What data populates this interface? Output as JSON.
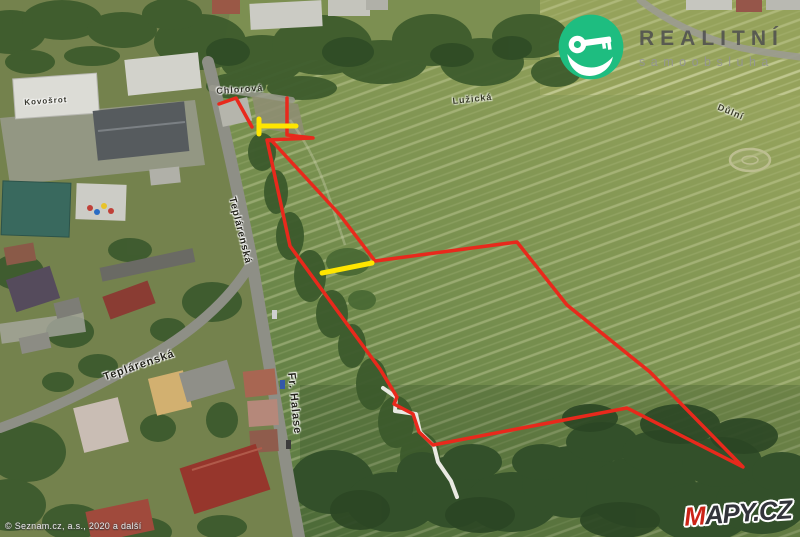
{
  "branding": {
    "realitni": {
      "line1": "REALITNÍ",
      "line2": "samoobsluha",
      "circle_color": "#1ebd80"
    },
    "mapycz": {
      "m": "M",
      "rest": "APY.CZ"
    }
  },
  "map": {
    "copyright": "© Seznam.cz, a.s., 2020 a další",
    "street_labels": {
      "top_entrance": "Chlorová",
      "mid_field": "Lužická",
      "far_right": "Důlní",
      "building": "Kovošrot",
      "teplarenska_vertical": "Teplárenská",
      "teplarenska_horizontal": "Teplárenská",
      "fr_halase": "Fr. Halase"
    },
    "annotation": {
      "outline_color": "#e8291c",
      "highlight_color": "#ffe600",
      "outline_width": 3.5,
      "highlight_width": 5,
      "red_polylines": [
        [
          [
            219,
            104
          ],
          [
            236,
            98
          ],
          [
            252,
            127
          ]
        ],
        [
          [
            287,
            98
          ],
          [
            287,
            135
          ],
          [
            313,
            138
          ],
          [
            267,
            140
          ],
          [
            290,
            246
          ],
          [
            333,
            305
          ],
          [
            380,
            369
          ],
          [
            397,
            397
          ],
          [
            394,
            404
          ],
          [
            413,
            414
          ],
          [
            419,
            432
          ],
          [
            433,
            445
          ],
          [
            627,
            408
          ],
          [
            743,
            467
          ],
          [
            650,
            372
          ],
          [
            567,
            305
          ],
          [
            517,
            242
          ],
          [
            375,
            261
          ],
          [
            340,
            215
          ],
          [
            272,
            141
          ],
          [
            268,
            140
          ]
        ]
      ],
      "yellow_segments": [
        [
          [
            259,
            119
          ],
          [
            259,
            134
          ]
        ],
        [
          [
            259,
            126
          ],
          [
            296,
            126
          ]
        ],
        [
          [
            322,
            273
          ],
          [
            372,
            263
          ]
        ]
      ]
    }
  }
}
